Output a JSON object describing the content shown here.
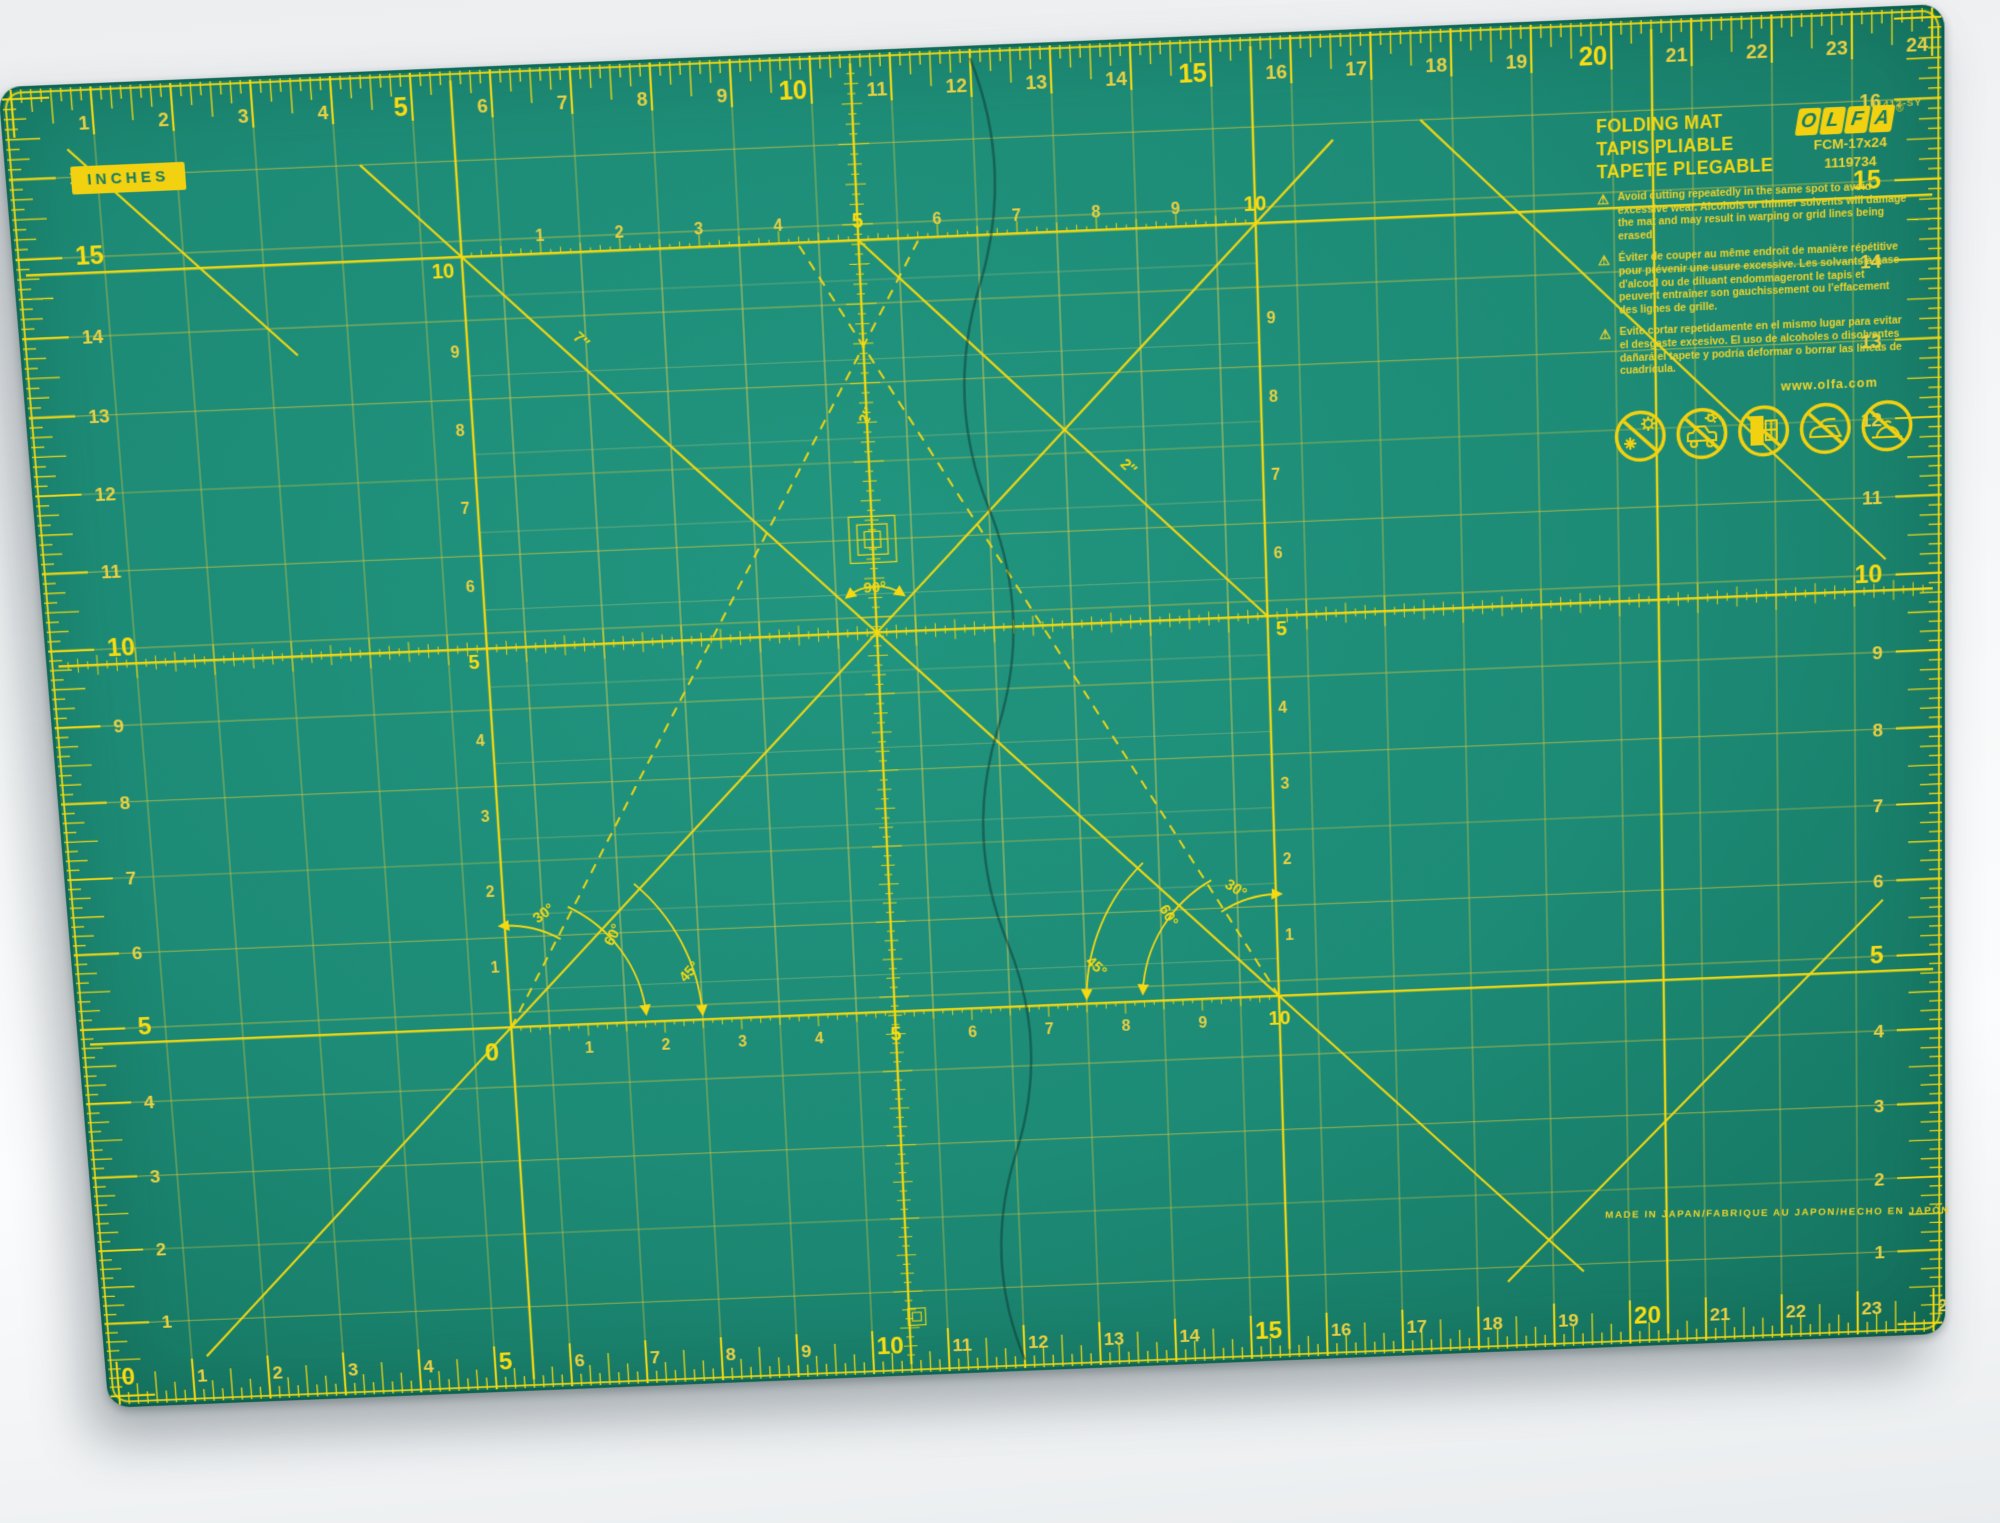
{
  "colors": {
    "mat_green": "#1d8b76",
    "mat_edge_green": "#13705c",
    "bright_yellow": "#f6d911",
    "line_yellow": "#d9c93f",
    "faint_yellow": "#d8d27a",
    "label_green": "#157a65",
    "fold_line": "#0b2f2a",
    "background": "#f3f5f7"
  },
  "inches_label": "INCHES",
  "brand": {
    "logo_letters": [
      "O",
      "L",
      "F",
      "A"
    ],
    "registered_mark": "®",
    "product_names": [
      "FOLDING MAT",
      "TAPIS PLIABLE",
      "TAPETE PLEGABLE"
    ],
    "model": "FCM-17x24",
    "item_number": "1119734",
    "print_code": "01412-SY",
    "website": "www.olfa.com",
    "made_in": "MADE IN JAPAN/FABRIQUE AU JAPON/HECHO EN JAPÓN"
  },
  "warnings": {
    "symbol": "⚠",
    "en": "Avoid cutting repeatedly in the same spot to avoid excessive wear. Alcohols or thinner solvents will damage the mat and may result in warping or grid lines being erased.",
    "fr": "Éviter de couper au même endroit de manière répétitive pour prévenir une usure excessive. Les solvants à base d'alcool ou de diluant endommageront le tapis et peuvent entraîner son gauchissement ou l'effacement des lignes de grille.",
    "es": "Evite cortar repetidamente en el mismo lugar para evitar el desgaste excesivo. El uso de alcoholes o disolventes dañará el tapete y podría deformar o borrar las líneas de cuadrícula."
  },
  "icons": [
    {
      "name": "no-extreme-temperature-icon"
    },
    {
      "name": "no-hot-car-icon"
    },
    {
      "name": "no-sunlight-window-icon"
    },
    {
      "name": "no-iron-icon"
    },
    {
      "name": "no-hot-objects-icon"
    }
  ],
  "rulers": {
    "top": {
      "numbers": [
        1,
        2,
        3,
        4,
        5,
        6,
        7,
        8,
        9,
        10,
        11,
        12,
        13,
        14,
        15,
        16,
        17,
        18,
        19,
        20,
        21,
        22,
        23,
        24
      ],
      "bold": [
        5,
        10,
        15,
        20
      ]
    },
    "bottom": {
      "numbers": [
        0,
        1,
        2,
        3,
        4,
        5,
        6,
        7,
        8,
        9,
        10,
        11,
        12,
        13,
        14,
        15,
        16,
        17,
        18,
        19,
        20,
        21,
        22,
        23,
        24
      ],
      "bold": [
        0,
        5,
        10,
        15,
        20
      ]
    },
    "left": {
      "numbers": [
        16,
        15,
        14,
        13,
        12,
        11,
        10,
        9,
        8,
        7,
        6,
        5,
        4,
        3,
        2,
        1
      ],
      "bold": [
        15,
        10,
        5
      ]
    },
    "right": {
      "numbers": [
        16,
        15,
        14,
        13,
        12,
        11,
        10,
        9,
        8,
        7,
        6,
        5,
        4,
        3,
        2,
        1
      ],
      "bold": [
        15,
        10,
        5
      ]
    }
  },
  "inner_grid": {
    "top_numbers": [
      1,
      2,
      3,
      4,
      5,
      6,
      7,
      8,
      9,
      10
    ],
    "bottom_numbers": [
      1,
      2,
      3,
      4,
      5,
      6,
      7,
      8,
      9,
      10
    ],
    "left_numbers": [
      10,
      9,
      8,
      7,
      6,
      5,
      4,
      3,
      2,
      1
    ],
    "right_numbers": [
      9,
      8,
      7,
      6,
      5,
      4,
      3,
      2,
      1
    ],
    "origin_label": "0",
    "bold": [
      5,
      10
    ]
  },
  "angle_labels": {
    "center": "90°",
    "left": [
      "30°",
      "60°",
      "45°"
    ],
    "right": [
      "30°",
      "60°",
      "45°"
    ]
  },
  "measure_labels": [
    "7″",
    "2″",
    "2″"
  ]
}
